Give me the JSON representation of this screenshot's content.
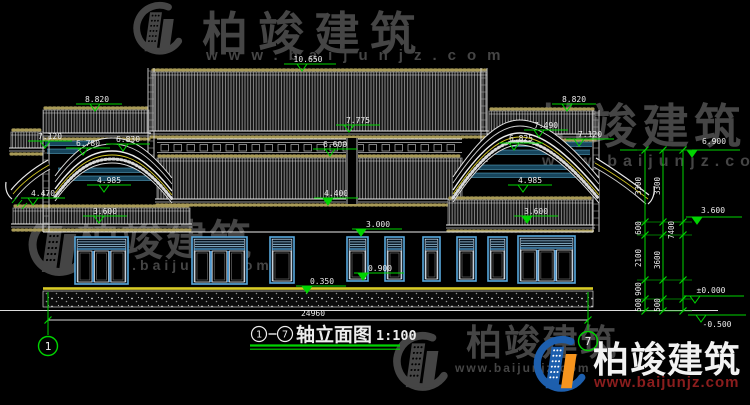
{
  "drawing": {
    "type": "architectural-elevation",
    "background": "#000000"
  },
  "title_block": {
    "axis_from": "1",
    "axis_to": "7",
    "title": "轴立面图",
    "scale": "1:100",
    "underline_color": "#00d400"
  },
  "axis_bubbles": [
    {
      "label": "1",
      "cx": 48,
      "cy": 346,
      "line_y1": 292,
      "line_y2": 335
    },
    {
      "label": "7",
      "cx": 588,
      "cy": 341,
      "line_y1": 292,
      "line_y2": 330
    }
  ],
  "overall_dim": {
    "label": "24960",
    "tx": 313,
    "ty": 316,
    "y": 320,
    "x1": 48,
    "x2": 588
  },
  "levels": [
    {
      "t": "10.650",
      "tx": 308,
      "ty": 62,
      "lx1": 284,
      "lx2": 336,
      "ly": 64,
      "trx": 302,
      "f": false
    },
    {
      "t": "8.820",
      "tx": 97,
      "ty": 102,
      "lx1": 76,
      "lx2": 122,
      "ly": 104,
      "trx": 95,
      "f": false
    },
    {
      "t": "7.120",
      "tx": 50,
      "ty": 139,
      "lx1": 28,
      "lx2": 72,
      "ly": 141,
      "trx": 45,
      "f": false
    },
    {
      "t": "6.780",
      "tx": 88,
      "ty": 146,
      "lx1": 66,
      "lx2": 110,
      "ly": 148,
      "trx": 83,
      "f": false
    },
    {
      "t": "6.830",
      "tx": 128,
      "ty": 142,
      "lx1": 106,
      "lx2": 150,
      "ly": 144,
      "trx": 123,
      "f": false
    },
    {
      "t": "4.985",
      "tx": 109,
      "ty": 183,
      "lx1": 87,
      "lx2": 131,
      "ly": 185,
      "trx": 104,
      "f": false
    },
    {
      "t": "4.470",
      "tx": 43,
      "ty": 196,
      "lx1": 21,
      "lx2": 65,
      "ly": 198,
      "trx": 33,
      "f": false
    },
    {
      "t": "3.600",
      "tx": 105,
      "ty": 214,
      "lx1": 83,
      "lx2": 127,
      "ly": 216,
      "trx": 99,
      "f": false
    },
    {
      "t": "7.775",
      "tx": 358,
      "ty": 123,
      "lx1": 336,
      "lx2": 380,
      "ly": 125,
      "trx": 349,
      "f": false
    },
    {
      "t": "6.600",
      "tx": 335,
      "ty": 147,
      "lx1": 313,
      "lx2": 357,
      "ly": 149,
      "trx": 330,
      "f": false
    },
    {
      "t": "4.400",
      "tx": 336,
      "ty": 196,
      "lx1": 314,
      "lx2": 358,
      "ly": 198,
      "trx": 328,
      "f": true
    },
    {
      "t": "3.000",
      "tx": 378,
      "ty": 227,
      "lx1": 352,
      "lx2": 402,
      "ly": 229,
      "trx": 361,
      "f": true
    },
    {
      "t": "0.900",
      "tx": 380,
      "ty": 271,
      "lx1": 354,
      "lx2": 404,
      "ly": 273,
      "trx": 363,
      "f": true
    },
    {
      "t": "0.350",
      "tx": 322,
      "ty": 284,
      "lx1": 296,
      "lx2": 346,
      "ly": 286,
      "trx": 307,
      "f": true
    },
    {
      "t": "8.820",
      "tx": 574,
      "ty": 102,
      "lx1": 552,
      "lx2": 596,
      "ly": 104,
      "trx": 567,
      "f": false
    },
    {
      "t": "7.490",
      "tx": 546,
      "ty": 128,
      "lx1": 524,
      "lx2": 568,
      "ly": 130,
      "trx": 539,
      "f": false
    },
    {
      "t": "6.825",
      "tx": 521,
      "ty": 141,
      "lx1": 499,
      "lx2": 543,
      "ly": 143,
      "trx": 514,
      "f": false
    },
    {
      "t": "7.120",
      "tx": 590,
      "ty": 137,
      "lx1": 566,
      "lx2": 614,
      "ly": 139,
      "trx": 579,
      "f": false
    },
    {
      "t": "6.900",
      "tx": 714,
      "ty": 144,
      "lx1": 620,
      "lx2": 740,
      "ly": 150,
      "trx": 692,
      "f": true
    },
    {
      "t": "4.985",
      "tx": 530,
      "ty": 183,
      "lx1": 508,
      "lx2": 552,
      "ly": 185,
      "trx": 523,
      "f": false
    },
    {
      "t": "3.600",
      "tx": 536,
      "ty": 214,
      "lx1": 514,
      "lx2": 558,
      "ly": 216,
      "trx": 527,
      "f": true
    },
    {
      "t": "3.600",
      "tx": 713,
      "ty": 213,
      "lx1": 686,
      "lx2": 742,
      "ly": 217,
      "trx": 697,
      "f": true
    },
    {
      "t": "±0.000",
      "tx": 711,
      "ty": 293,
      "lx1": 684,
      "lx2": 744,
      "ly": 296,
      "trx": 695,
      "f": false
    },
    {
      "t": "-0.500",
      "tx": 717,
      "ty": 327,
      "lx1": 688,
      "lx2": 746,
      "ly": 315,
      "trx": 701,
      "f": false
    }
  ],
  "vertical_dims": {
    "lines": [
      645,
      663,
      683
    ],
    "y_top": 150,
    "y_bottom": 311,
    "ticks": [
      150,
      222,
      235,
      280,
      299,
      311
    ],
    "texts": [
      {
        "t": "3300",
        "x": 641,
        "y": 186
      },
      {
        "t": "600",
        "x": 641,
        "y": 228
      },
      {
        "t": "2100",
        "x": 641,
        "y": 258
      },
      {
        "t": "900",
        "x": 641,
        "y": 289
      },
      {
        "t": "500",
        "x": 641,
        "y": 305
      },
      {
        "t": "3300",
        "x": 660,
        "y": 186
      },
      {
        "t": "3600",
        "x": 660,
        "y": 260
      },
      {
        "t": "500",
        "x": 660,
        "y": 305
      },
      {
        "t": "7400",
        "x": 674,
        "y": 230
      }
    ]
  },
  "watermarks": {
    "brand": "柏竣建筑",
    "url": "www.baijunjz.com",
    "gray_color": "#454545",
    "logo_blue": "#1d5fae",
    "logo_orange": "#f7941d",
    "url_red": "#8a1d1d",
    "items": [
      {
        "id": "top",
        "style": "gray",
        "logo": {
          "x": 126,
          "y": 2,
          "s": 0.85
        },
        "text": {
          "x": 202,
          "y": 50,
          "size": 46,
          "ls": 10
        },
        "urlp": {
          "x": 206,
          "y": 60,
          "size": 15,
          "ls": 11
        }
      },
      {
        "id": "right",
        "style": "gray",
        "text": {
          "x": 538,
          "y": 143,
          "size": 47,
          "ls": 5
        },
        "urlp": {
          "x": 542,
          "y": 166,
          "size": 16,
          "ls": 6
        }
      },
      {
        "id": "left",
        "style": "gray",
        "logo": {
          "x": 20,
          "y": 214,
          "s": 1.0
        },
        "text": {
          "x": 77,
          "y": 255,
          "size": 42,
          "ls": 2
        },
        "urlp": {
          "x": 88,
          "y": 270,
          "size": 14,
          "ls": 4
        }
      },
      {
        "id": "bottom",
        "style": "gray",
        "logo": {
          "x": 385,
          "y": 332,
          "s": 0.95
        },
        "text": {
          "x": 466,
          "y": 355,
          "size": 36,
          "ls": 2
        },
        "urlp": {
          "x": 455,
          "y": 372,
          "size": 12,
          "ls": 2
        }
      },
      {
        "id": "brand-color",
        "style": "color",
        "logo": {
          "x": 526,
          "y": 336,
          "s": 0.9
        },
        "text": {
          "x": 593,
          "y": 372,
          "size": 36,
          "ls": 1
        },
        "urlp": {
          "x": 594,
          "y": 387,
          "size": 15,
          "ls": 1
        }
      }
    ]
  },
  "colors": {
    "cad_white": "#ececec",
    "cad_green": "#00d400",
    "cad_green_dim": "#00a000",
    "yellow": "#d8cb25",
    "tan": "#a89a57",
    "window_frame_blue": "#58a8dc",
    "window_light_blue": "#cfe6f8",
    "beam_teal": "#17455c",
    "beam_teal_line": "#62b8da"
  }
}
